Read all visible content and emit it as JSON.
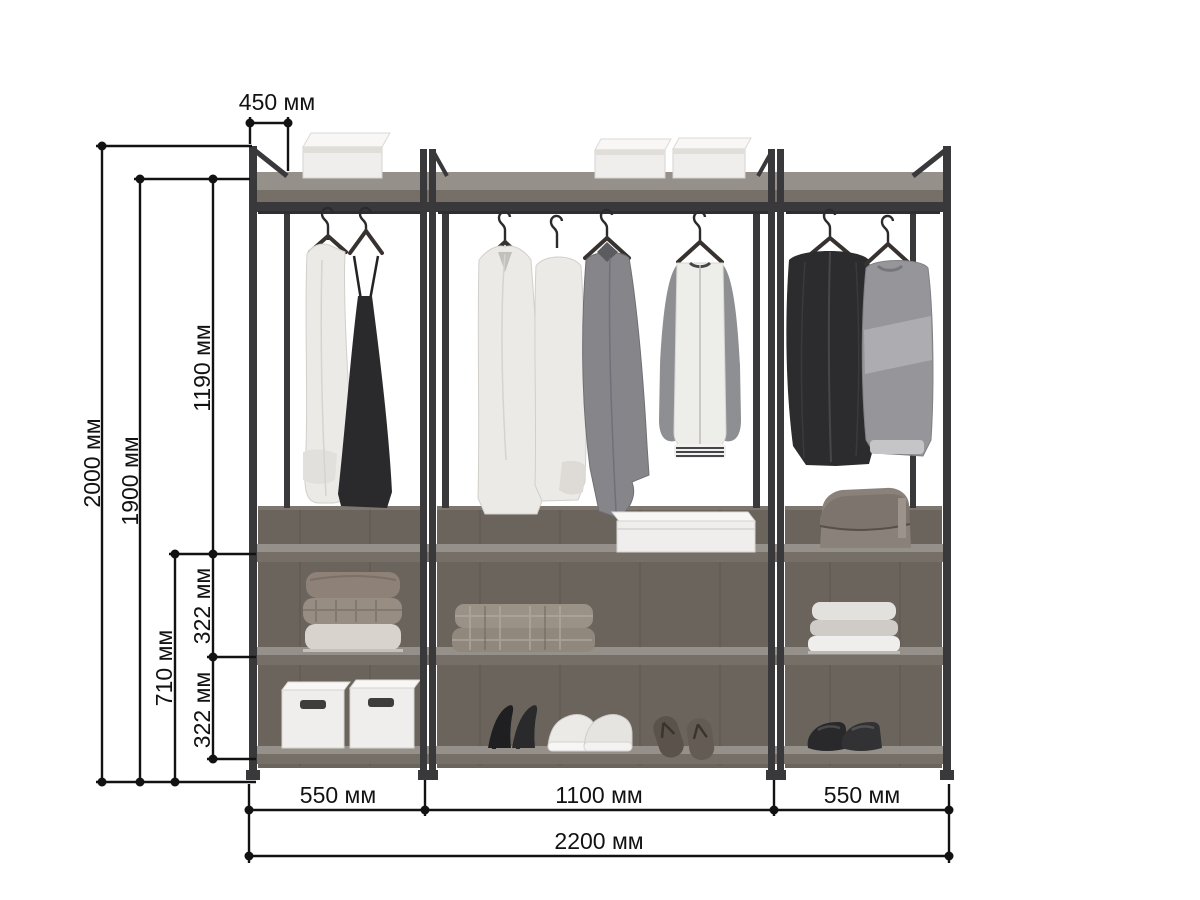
{
  "colors": {
    "bg": "#ffffff",
    "frame": "#39393b",
    "wood_top": "#96908a",
    "wood_edge": "#756f68",
    "wood_back": "#6b645d",
    "dim": "#121212"
  },
  "dimensions": {
    "depth": "450 мм",
    "total_height": "2000 мм",
    "shelf_height": "1900 мм",
    "hanging_height": "1190 мм",
    "lower_section": "710 мм",
    "shelf_gap_top": "322 мм",
    "shelf_gap_bottom": "322 мм",
    "left_width": "550 мм",
    "center_width": "1100 мм",
    "right_width": "550 мм",
    "total_width": "2200 мм"
  }
}
